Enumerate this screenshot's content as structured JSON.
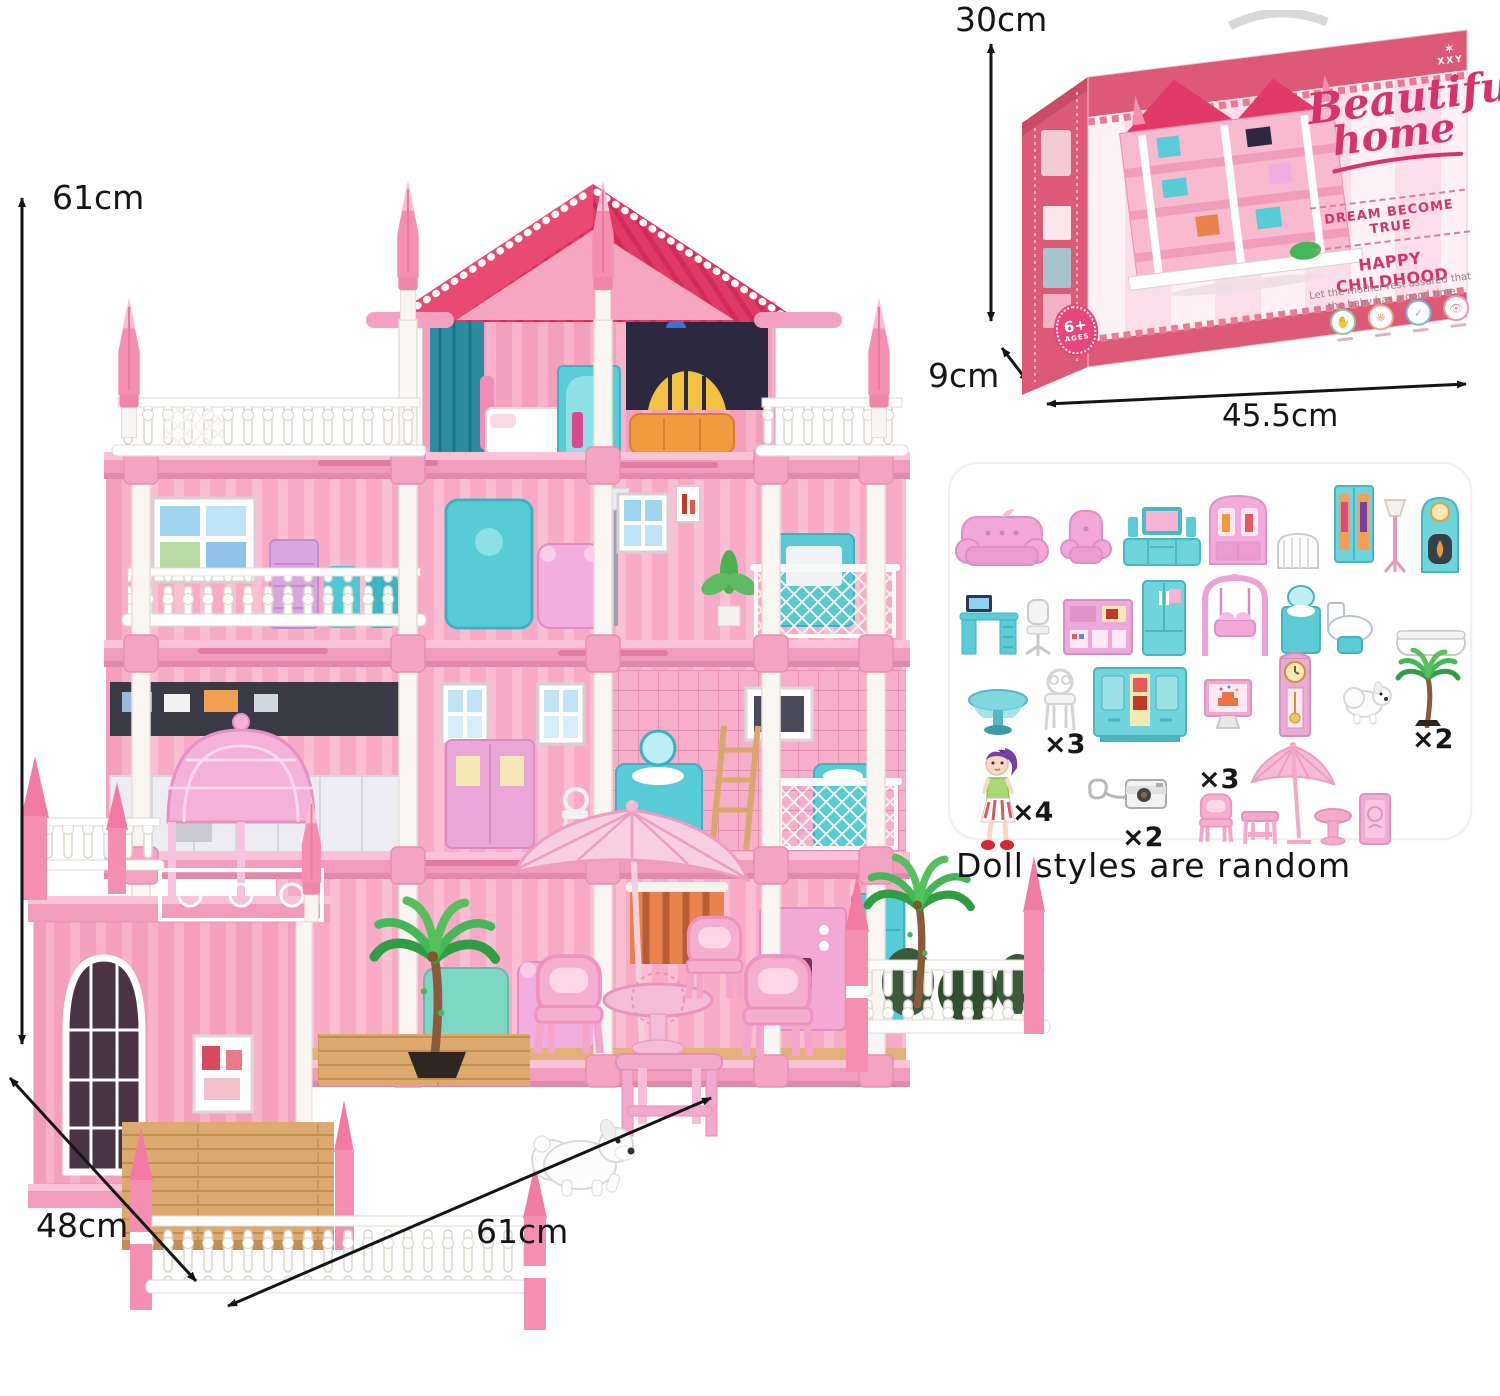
{
  "page": {
    "background": "#ffffff"
  },
  "dimension_labels": {
    "house_height": "61cm",
    "house_depth": "48cm",
    "house_width": "61cm",
    "box_height": "30cm",
    "box_depth": "9cm",
    "box_width": "45.5cm"
  },
  "box": {
    "band_text": "Beautiful home",
    "brand_line1": "Beautiful",
    "brand_line2": "home",
    "tagline": "DREAM BECOME TRUE",
    "slogan_title": "HAPPY CHILDHOOD",
    "slogan_line1": "Let the mother rest assured that",
    "slogan_line2": "the baby has a good time",
    "age_badge": "6+",
    "age_badge_sub": "AGES",
    "emblem_letters": "XXY",
    "emblem_glyph": "✶"
  },
  "accessories_panel": {
    "note": "Doll styles are random",
    "quantities": {
      "white_chair": "×3",
      "palm_tree": "×2",
      "doll": "×4",
      "camera": "×2",
      "patio_chair": "×3"
    },
    "items": [
      "pink-loveseat",
      "pink-armchair",
      "tv-cabinet",
      "display-hutch",
      "baby-crib",
      "wardrobe",
      "floor-lamp",
      "fireplace-clock",
      "computer-desk",
      "office-chair",
      "kitchen-counter",
      "refrigerator",
      "garden-swing",
      "bathroom-vanity-set",
      "bathtub",
      "round-pedestal-table",
      "white-dining-chair",
      "sideboard-cupboard",
      "cake-screen",
      "grandfather-clock",
      "puppy",
      "palm-tree",
      "doll",
      "camera-keychain",
      "patio-chair",
      "patio-side-table",
      "patio-umbrella",
      "patio-stool",
      "patio-cabinet"
    ]
  },
  "colors": {
    "brand_pink": "#d6336c",
    "box_band_pink": "#dd5a76",
    "house_wall_pink": "#f8abc6",
    "roof_crimson": "#e23a67",
    "accent_teal": "#5ccbd6",
    "arrow_black": "#151515"
  }
}
